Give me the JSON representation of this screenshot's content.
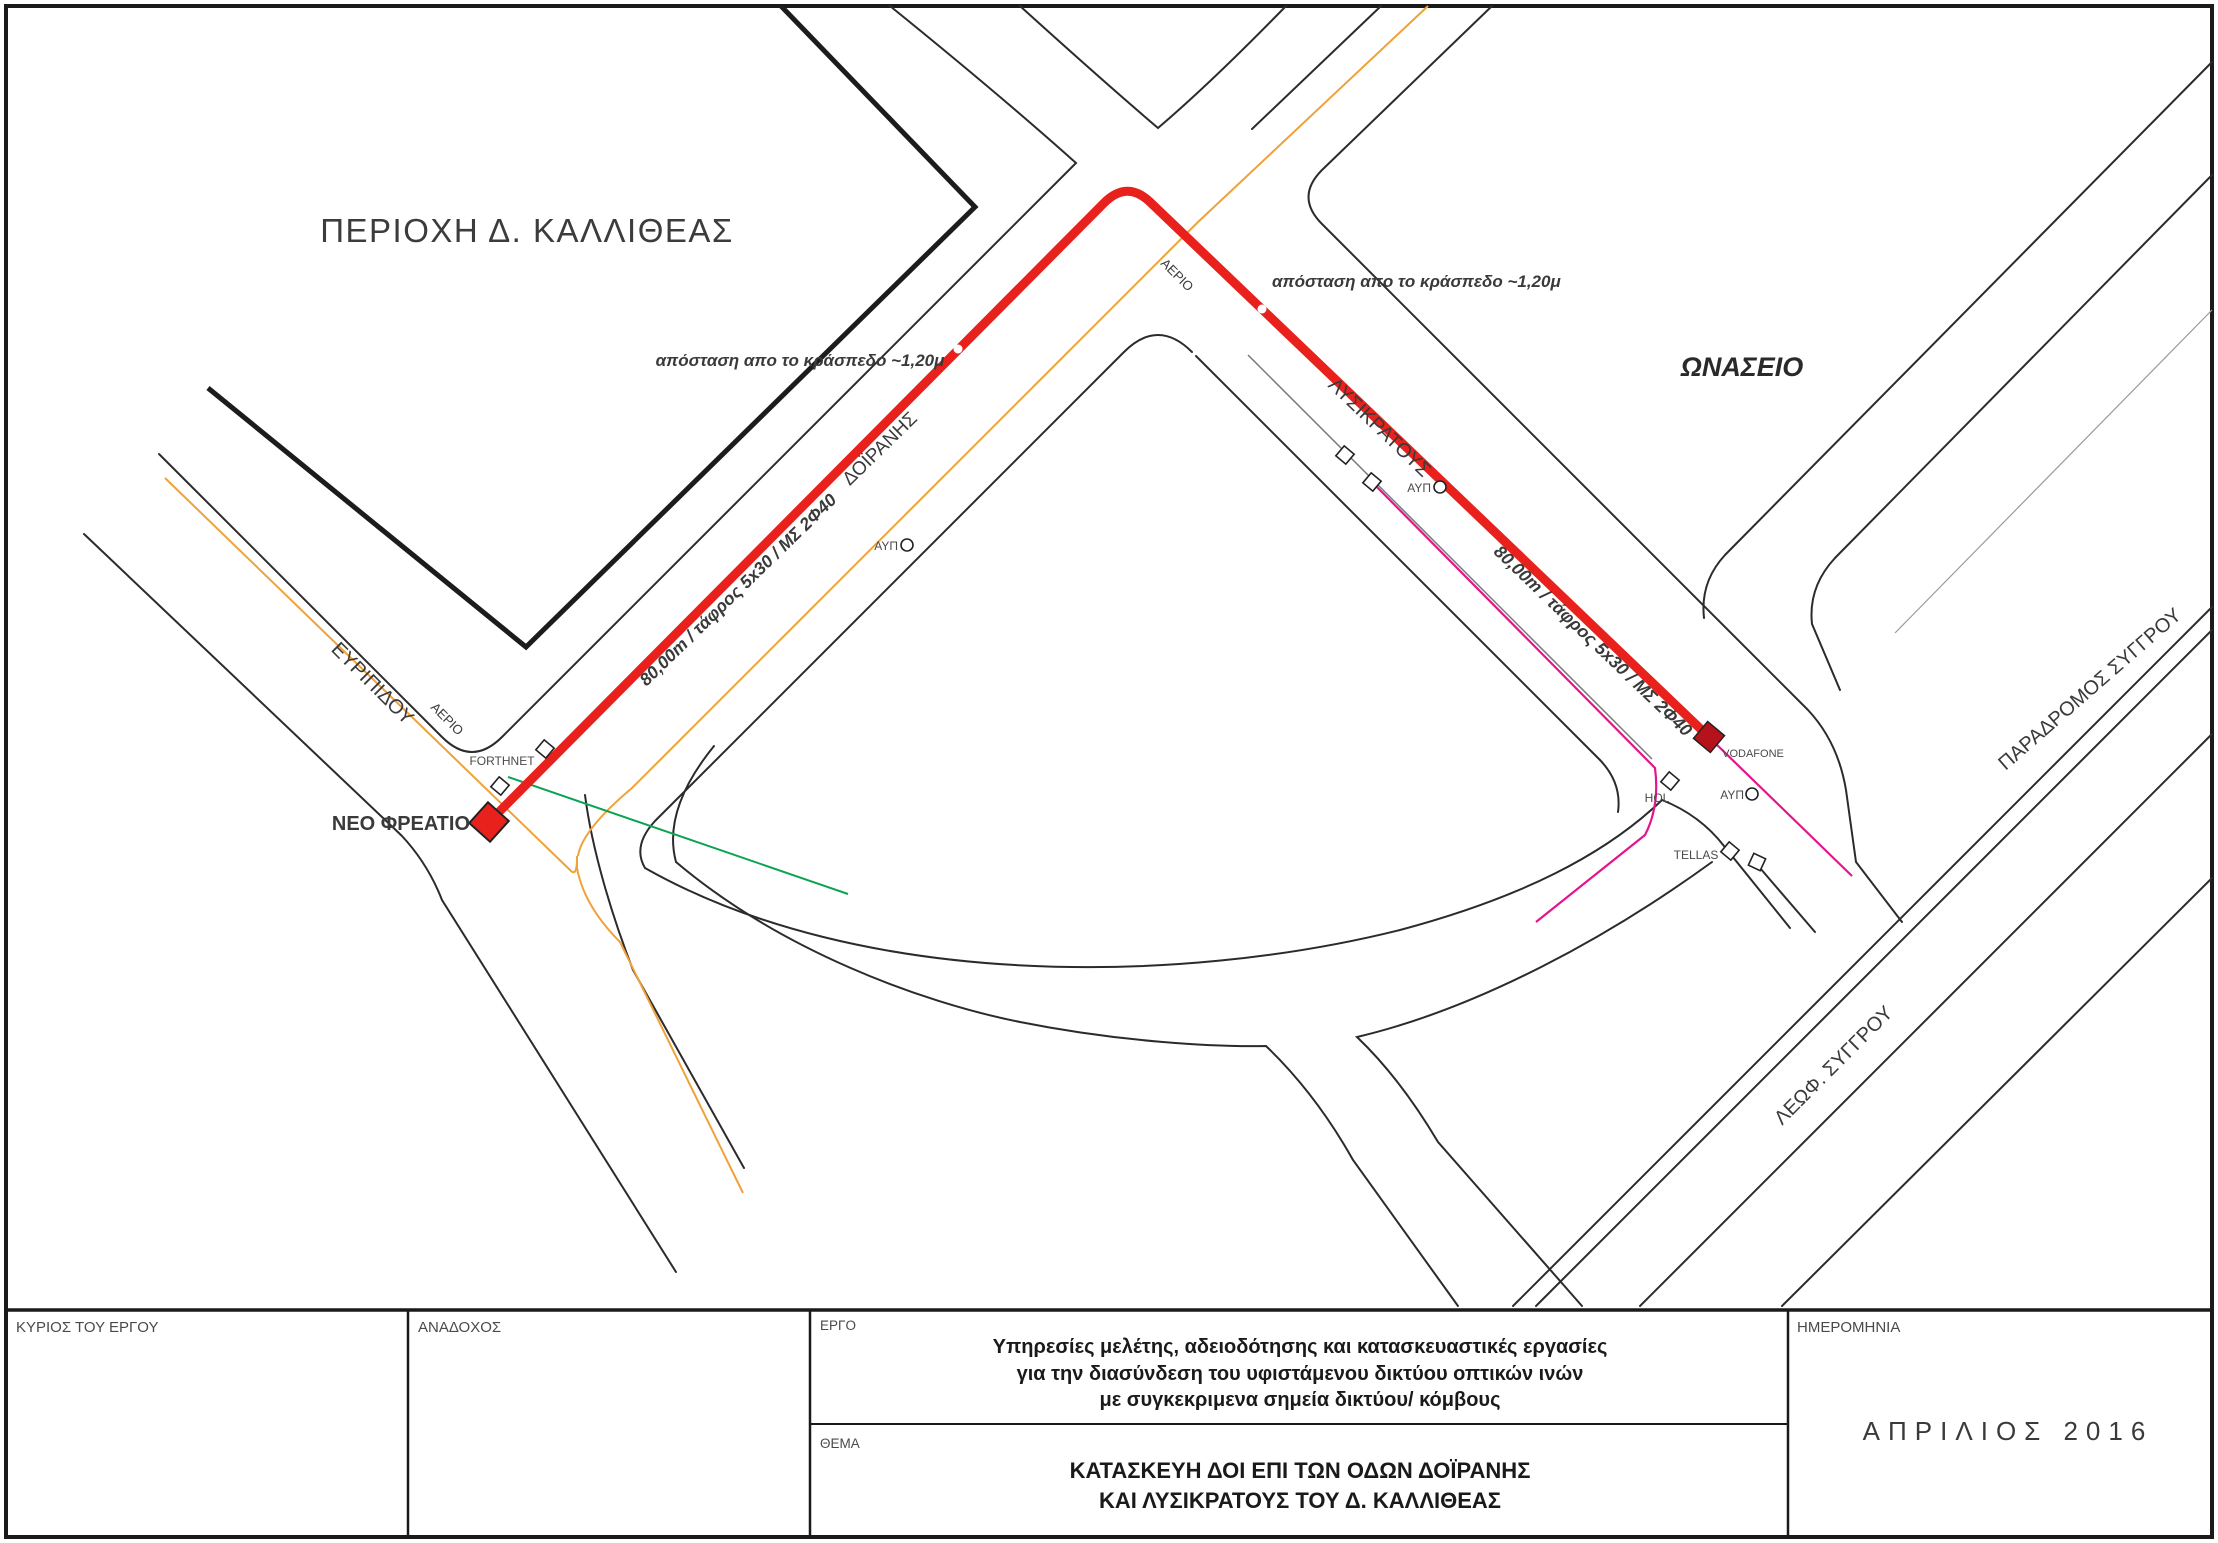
{
  "sheet": {
    "region_label": "ΠΕΡΙΟΧΗ Δ. ΚΑΛΛΙΘΕΑΣ",
    "landmark_label": "ΩΝΑΣΕΙΟ"
  },
  "streets": {
    "evripidou": "ΕΥΡΙΠΙΔΟΥ",
    "lysikratous": "ΛΥΣΙΚΡΑΤΟΥΣ",
    "doiranis": "ΔΟΪΡΑΝΗΣ",
    "leoforos_syggrou": "ΛΕΩΦ. ΣΥΓΓΡΟΥ",
    "paradromos_syggrou": "ΠΑΡΑΔΡΟΜΟΣ ΣΥΓΓΡΟΥ"
  },
  "route": {
    "doiranis_segment_label": "80,00m / τάφρος 5x30 / ΜΣ 2Φ40",
    "lysikratous_segment_label": "80,00m / τάφρος 5x30 / ΜΣ 2Φ40",
    "new_manhole_label": "ΝΕΟ ΦΡΕΑΤΙΟ",
    "curb_distance_note_doiranis": "απόσταση απο το κράσπεδο ~1,20μ",
    "curb_distance_note_lysikratous": "απόσταση απο το κράσπεδο ~1,20μ"
  },
  "utilities": {
    "gas_label": "ΑΕΡΙΟ",
    "ayp_label": "ΑΥΠ",
    "forthnet_label": "FORTHNET",
    "vodafone_label": "VODAFONE",
    "hol_label": "HOL",
    "tellas_label": "TELLAS"
  },
  "colors": {
    "route_red": "#e8211d",
    "terminus_red": "#b5121b",
    "gas_orange": "#f0a23a",
    "fiber_green": "#0aa351",
    "telecom_magenta": "#e5148c"
  },
  "title_block": {
    "owner_label": "ΚΥΡΙΟΣ ΤΟΥ ΕΡΓΟΥ",
    "contractor_label": "ΑΝΑΔΟΧΟΣ",
    "project_label": "ΕΡΓΟ",
    "project_line1": "Υπηρεσίες μελέτης, αδειοδότησης και κατασκευαστικές εργασίες",
    "project_line2": "για την διασύνδεση του υφιστάμενου δικτύου οπτικών ινών",
    "project_line3": "με συγκεκριμενα σημεία δικτύου/ κόμβους",
    "subject_label": "ΘΕΜΑ",
    "subject_line1": "ΚΑΤΑΣΚΕΥΗ ΔΟΙ ΕΠΙ ΤΩΝ ΟΔΩΝ ΔΟΪΡΑΝΗΣ",
    "subject_line2": "ΚΑΙ ΛΥΣΙΚΡΑΤΟΥΣ ΤΟΥ Δ. ΚΑΛΛΙΘΕΑΣ",
    "date_label": "ΗΜΕΡΟΜΗΝΙΑ",
    "date_value": "ΑΠΡΙΛΙΟΣ   2016"
  }
}
